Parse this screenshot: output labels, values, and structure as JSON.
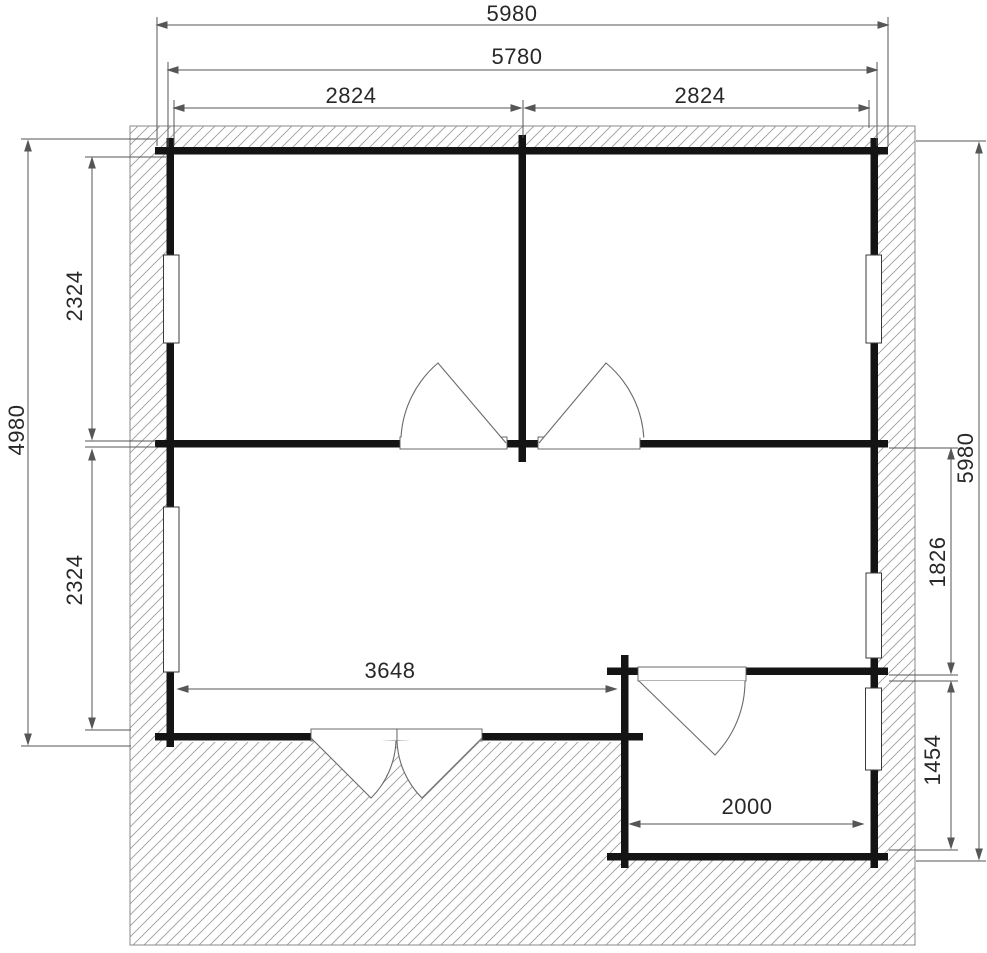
{
  "floor_plan": {
    "dimensions": {
      "top_overall": "5980",
      "top_wall_outer": "5780",
      "top_room_left_width": "2824",
      "top_room_right_width": "2824",
      "left_overall": "4980",
      "left_room_upper_depth": "2324",
      "left_room_lower_depth": "2324",
      "right_overall": "5980",
      "right_upper_segment": "1826",
      "right_annex_depth": "1454",
      "bottom_main_width": "3648",
      "annex_width": "2000"
    },
    "colors": {
      "wall": "#141414",
      "hatch_line": "#9d9d9d",
      "dimension_line": "#565656",
      "label_text": "#282828",
      "background": "#ffffff",
      "window_fill": "#ffffff"
    }
  }
}
